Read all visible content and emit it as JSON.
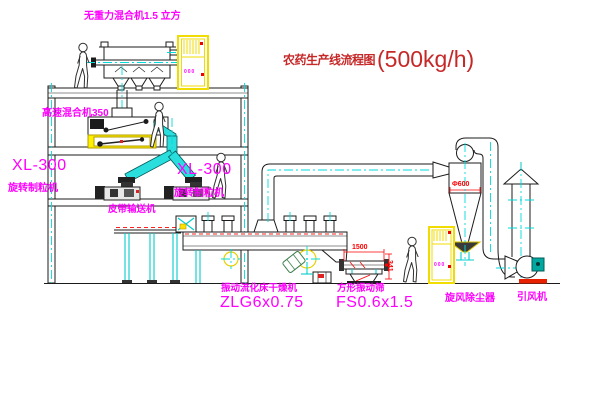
{
  "title": {
    "text": "农药生产线流程图",
    "capacity": "(500kg/h)"
  },
  "labels": {
    "gravity_mixer": "无重力混合机1.5 立方",
    "high_speed_mixer": "高速混合机350",
    "granulator_left_model": "XL-300",
    "granulator_left_name": "旋转制粒机",
    "granulator_right_model": "XL-300",
    "granulator_right_name": "旋转制粒机",
    "belt_conveyor": "皮带输送机",
    "dryer_name": "振动流化床干燥机",
    "dryer_model": "ZLG6x0.75",
    "screen_name": "方形振动筛",
    "screen_model": "FS0.6x1.5",
    "cyclone": "旋风除尘器",
    "fan": "引风机"
  },
  "dimensions": {
    "screen_width": "1500",
    "screen_height": "341",
    "cyclone_diameter": "Φ600"
  },
  "cabinets": {
    "top_panel_display": "000",
    "bottom_panel_display": "000"
  },
  "colors": {
    "label_magenta": "#ff00ff",
    "title_red": "#c62828",
    "dimension_red": "#ff0000",
    "line_black": "#1b1b1b",
    "centerline_cyan": "#00dcdc",
    "cabinet_yellow": "#f0dc00",
    "chute_cyan": "#2adede"
  }
}
